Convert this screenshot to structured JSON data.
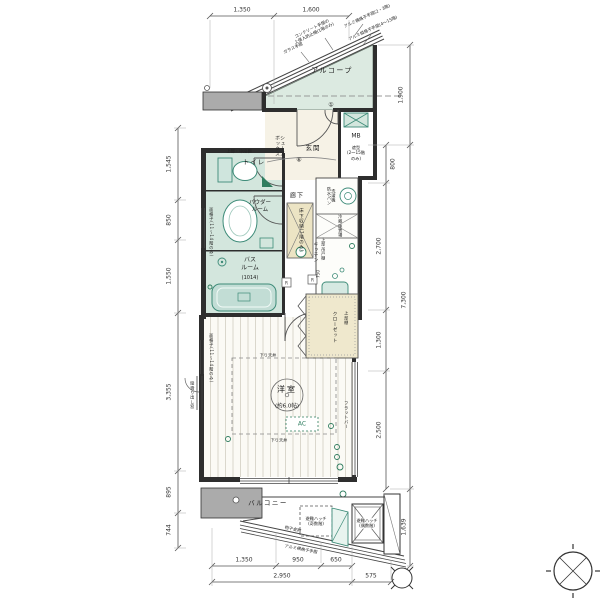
{
  "rooms": {
    "alcove": "アルコープ",
    "genkan": "玄関",
    "shoes": "シューズ\nボックス",
    "mb": "MB",
    "mb_note": "遮型\n(2〜15階\nのみ)",
    "toilet": "トイレ",
    "toilet_shelf": "上部・中段棚",
    "powder": "パウダー\nルーム",
    "bath": "バス\nルーム",
    "bath_size": "(1014)",
    "hallway": "廊下",
    "floor_storage": "床下収納(1階のみ)",
    "kitchen": "キッチン",
    "washer": "洗濯機\n防水パン",
    "fridge": "冷蔵庫置場",
    "cupboard": "上部吊戸棚",
    "closet": "クローゼット",
    "closet_shelf": "上部棚",
    "room": "洋室",
    "room_size": "(約6.0帖)",
    "ac": "AC",
    "down_ceiling": "下り天井",
    "flat_bar": "フラットバー",
    "casement": "縦滑り出し窓",
    "grille": "面格子(11〜14階のみ)",
    "balcony": "バルコニー",
    "hatch_odd": "避難ハッチ\n(奇数階)",
    "hatch_even": "避難ハッチ\n(偶数階)",
    "monohoshi": "物干金物",
    "balcony_rail": "アルミ横格子手摺",
    "remote": "R",
    "gas": "G"
  },
  "railing_notes": {
    "concrete": "コンクリート手摺の\n上侵入防止柵(1階のみ)",
    "glass": "ガラス手摺",
    "alumi_h": "アルミ横格子手摺(2・3階)",
    "alumi_v": "アルミ縦格子手摺(4〜15階)"
  },
  "symbols": {
    "circle_1": "①",
    "circle_2": "⑥"
  },
  "dimensions": {
    "top": [
      "1,350",
      "1,600"
    ],
    "left": [
      "1,545",
      "850",
      "1,550",
      "3,355",
      "895",
      "744"
    ],
    "right_outer": [
      "1,900",
      "7,300",
      "1,639"
    ],
    "right_inner": [
      "800",
      "2,700",
      "1,300",
      "2,500"
    ],
    "bottom_upper": [
      "1,350",
      "950",
      "650"
    ],
    "bottom_lower": [
      "2,950",
      "575"
    ],
    "kitchen": "750"
  },
  "colors": {
    "room_teal": "#d3e6dd",
    "alcove_green": "#dceae1",
    "beige": "#ece4c4",
    "closet_beige": "#efe8cd",
    "wall_gray": "#ababab",
    "fixture_teal": "#3d8b78",
    "accent_green": "#2f7d5f"
  }
}
